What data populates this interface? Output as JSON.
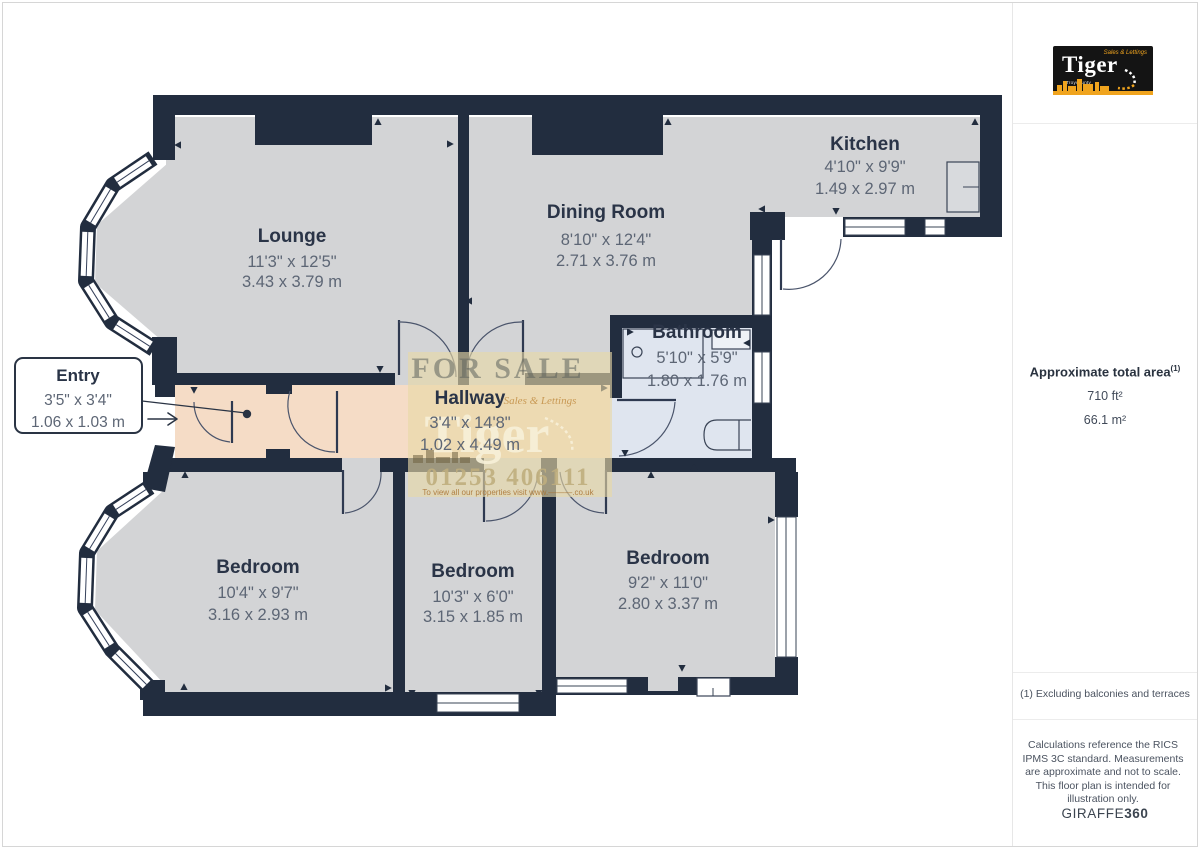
{
  "plan": {
    "rooms": [
      {
        "id": "lounge",
        "name": "Lounge",
        "dims_ft": "11'3\" x 12'5\"",
        "dims_m": "3.43 x 3.79 m"
      },
      {
        "id": "dining-room",
        "name": "Dining Room",
        "dims_ft": "8'10\" x 12'4\"",
        "dims_m": "2.71 x 3.76 m"
      },
      {
        "id": "kitchen",
        "name": "Kitchen",
        "dims_ft": "4'10\" x 9'9\"",
        "dims_m": "1.49 x 2.97 m"
      },
      {
        "id": "bathroom",
        "name": "Bathroom",
        "dims_ft": "5'10\" x 5'9\"",
        "dims_m": "1.80 x 1.76 m"
      },
      {
        "id": "hallway",
        "name": "Hallway",
        "dims_ft": "3'4\" x 14'8\"",
        "dims_m": "1.02 x 4.49 m"
      },
      {
        "id": "bedroom-1",
        "name": "Bedroom",
        "dims_ft": "10'4\" x 9'7\"",
        "dims_m": "3.16 x 2.93 m"
      },
      {
        "id": "bedroom-2",
        "name": "Bedroom",
        "dims_ft": "10'3\" x 6'0\"",
        "dims_m": "3.15 x 1.85 m"
      },
      {
        "id": "bedroom-3",
        "name": "Bedroom",
        "dims_ft": "9'2\" x 11'0\"",
        "dims_m": "2.80 x 3.37 m"
      }
    ],
    "entry_callout": {
      "name": "Entry",
      "dims_ft": "3'5\" x 3'4\"",
      "dims_m": "1.06 x 1.03 m"
    }
  },
  "watermark": {
    "for_sale": "FOR SALE",
    "tagline": "Sales & Lettings",
    "brand": "Tiger",
    "phone": "01253 406111",
    "visit": "To view all our properties visit www.———.co.uk"
  },
  "sidebar": {
    "logo": {
      "brand": "Tiger",
      "tagline": "Sales & Lettings",
      "subtext": "Troycounty"
    },
    "area": {
      "title": "Approximate total area",
      "sup": "(1)",
      "sqft": "710 ft²",
      "sqm": "66.1 m²"
    },
    "footnote": "(1) Excluding balconies and terraces",
    "disclaimer": "Calculations reference the RICS IPMS 3C standard. Measurements are approximate and not to scale. This floor plan is intended for illustration only.",
    "brand_footer": {
      "normal": "GIRAFFE",
      "bold": "360"
    }
  },
  "colors": {
    "wall": "#222d3f",
    "floor": "#d3d4d6",
    "hall": "#f5dcc6",
    "bath": "#dfe5ef",
    "accent": "#f0a41e",
    "label": "#2a3447",
    "dims": "#5d6675",
    "line": "#4a546b"
  }
}
